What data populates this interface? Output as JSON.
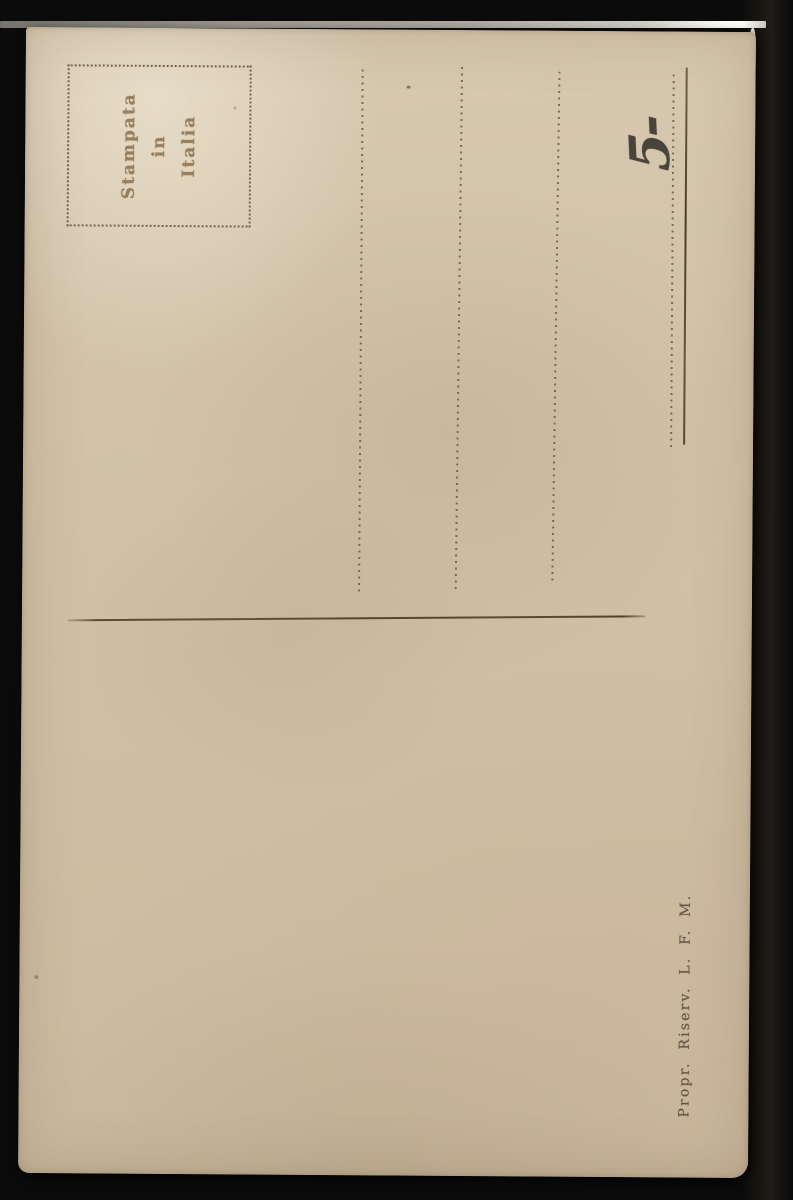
{
  "postcard": {
    "stamp_box": {
      "lines": [
        "Stampata",
        "in",
        "Italia"
      ]
    },
    "handwritten_note": "5-",
    "imprint": "Propr. Riserv. L. F. M."
  },
  "colors": {
    "background": "#0b0b0b",
    "card": "#cfc0a6",
    "ink": "#6a563f",
    "stamp_ink": "#8d7453",
    "line_ink": "#55442f",
    "imprint_ink": "#5a4a3b",
    "handwriting_ink": "#38322b"
  }
}
